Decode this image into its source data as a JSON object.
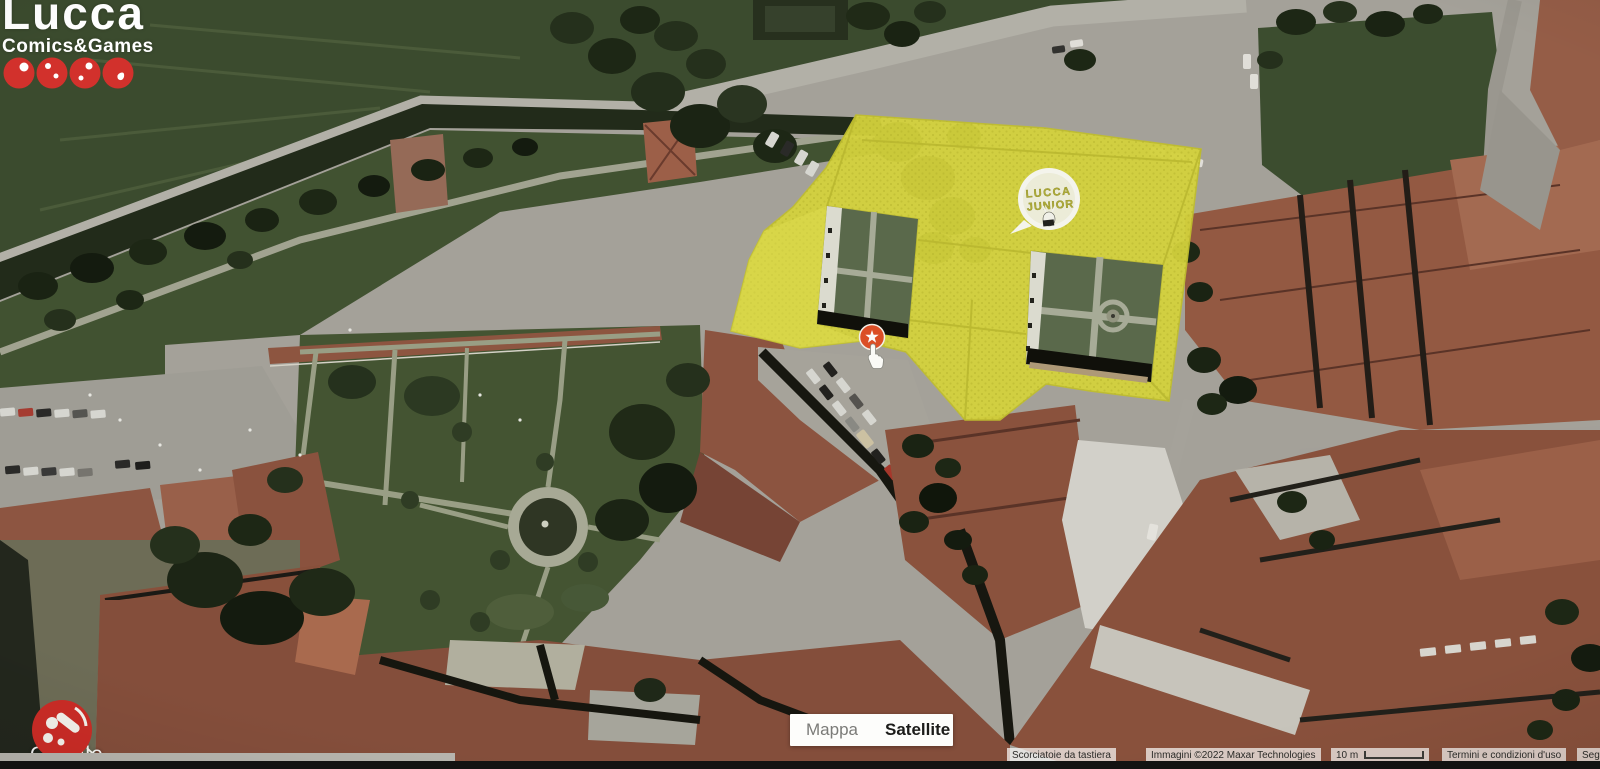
{
  "branding": {
    "logo_line1": "Lucca",
    "logo_line2": "Comics&Games"
  },
  "overlay_badge": {
    "line1": "LUCCA",
    "line2": "JUNIOR"
  },
  "map_controls": {
    "map_button": "Mappa",
    "satellite_button": "Satellite"
  },
  "attribution": {
    "keyboard_shortcuts": "Scorciatoie da tastiera",
    "imagery": "Immagini ©2022 Maxar Technologies",
    "scale_label": "10 m",
    "terms": "Termini e condizioni d'uso",
    "report": "Seg"
  },
  "watermark": {
    "google": "Google"
  },
  "colors": {
    "overlay_yellow": "#d7d52e",
    "marker_red": "#ea4c1f",
    "logo_red": "#d2312c",
    "badge_text": "#b3b02c"
  }
}
